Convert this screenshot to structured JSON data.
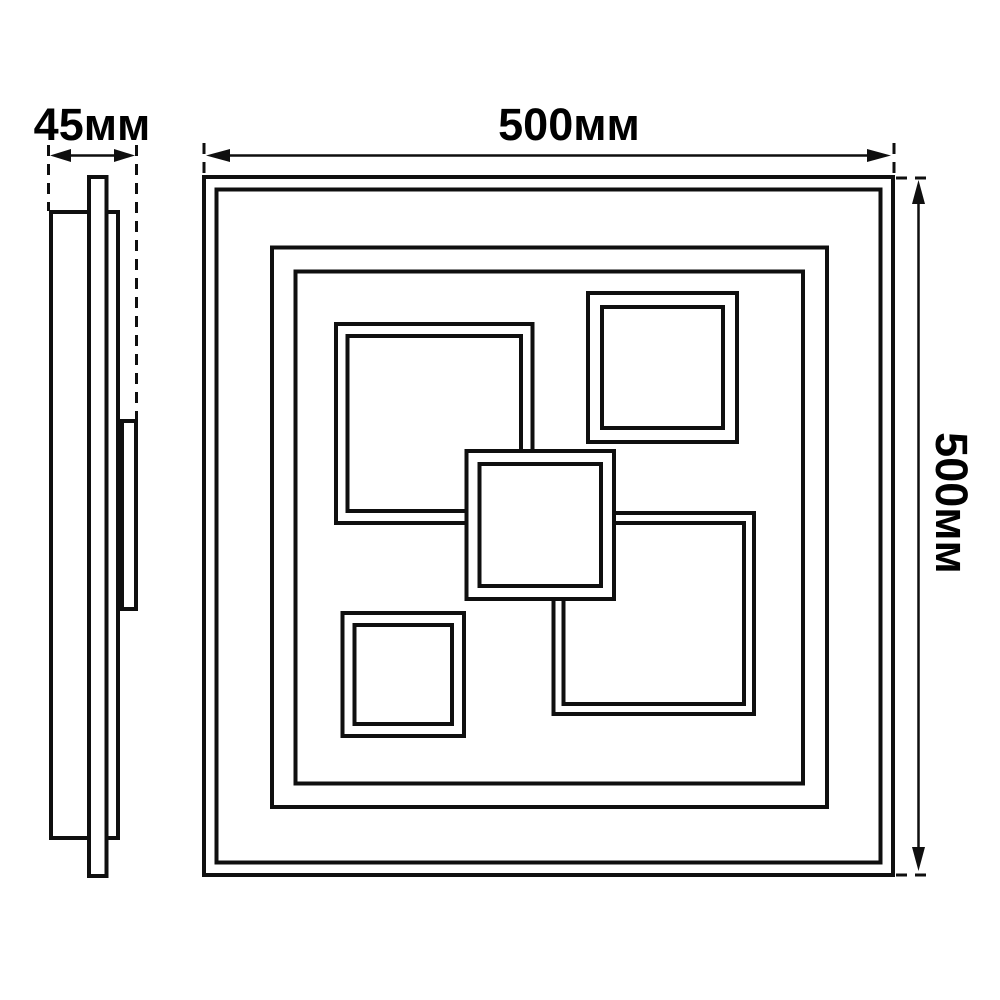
{
  "side_view": {
    "depth_dimension_label": "45мм"
  },
  "front_view": {
    "width_dimension_label": "500мм",
    "height_dimension_label": "500мм"
  },
  "colors": {
    "line": "#0f0f0f",
    "text": "#000000",
    "background": "#ffffff"
  }
}
